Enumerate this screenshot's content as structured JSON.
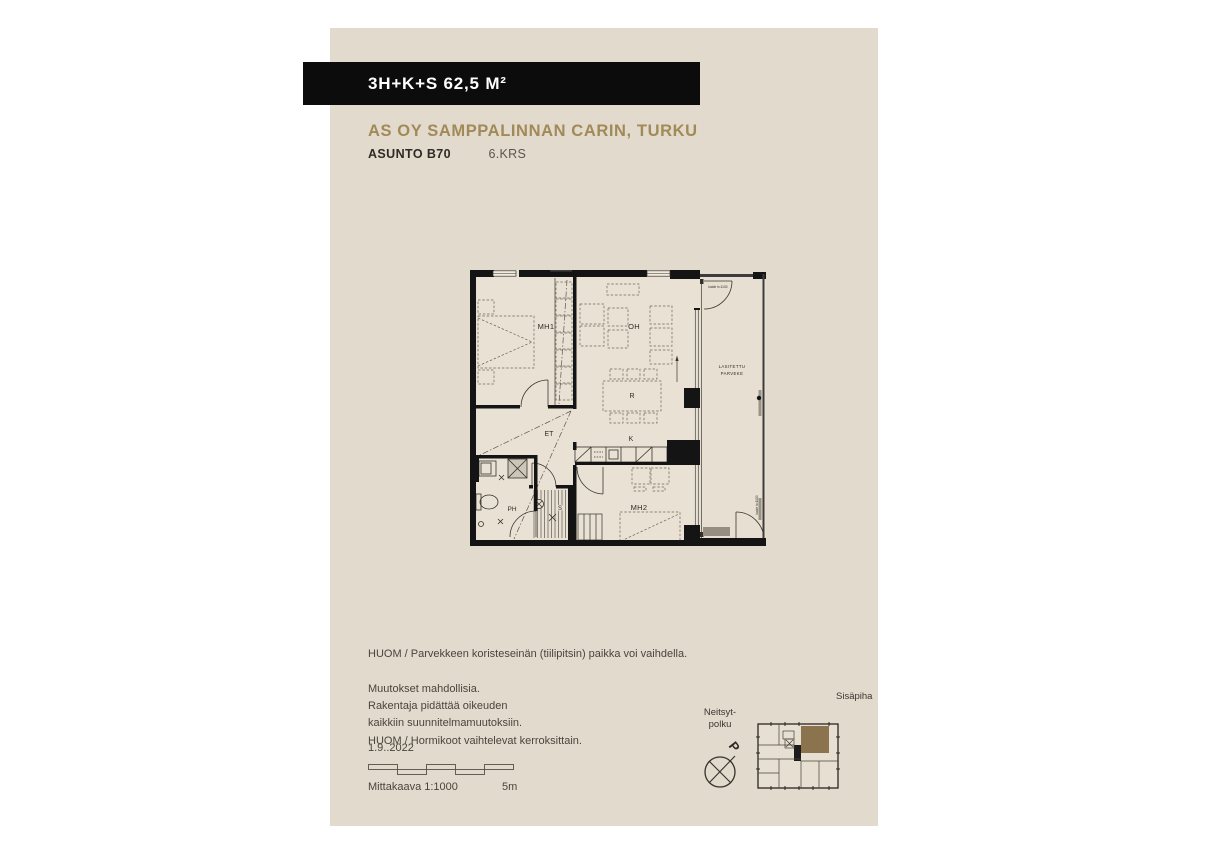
{
  "header": {
    "unit_type": "3H+K+S 62,5 M²",
    "project": "AS OY SAMPPALINNAN CARIN, TURKU",
    "apartment": "ASUNTO B70",
    "floor": "6.KRS"
  },
  "plan": {
    "rooms": {
      "mh1": "MH1",
      "oh": "OH",
      "r": "R",
      "k": "K",
      "et": "ET",
      "ph": "PH",
      "s": "S",
      "mh2": "MH2"
    },
    "balcony_line1": "LASITETTU",
    "balcony_line2": "PARVEKE",
    "railing_note": "kaide h=1100"
  },
  "notes": {
    "balcony_note": "HUOM / Parvekkeen koristeseinän (tiilipitsin) paikka voi vaihdella.",
    "disclaimer_lines": [
      "Muutokset mahdollisia.",
      "Rakentaja pidättää oikeuden",
      "kaikkiin suunnitelmamuutoksiin.",
      "HUOM / Hormikoot vaihtelevat kerroksittain."
    ],
    "date": "1.9..2022",
    "scale_label": "Mittakaava 1:1000",
    "scale_length": "5m"
  },
  "site": {
    "courtyard_label": "Sisäpiha",
    "street_label_line1": "Neitsyt-",
    "street_label_line2": "polku",
    "compass_letter": "P"
  },
  "colors": {
    "panel_bg": "#e2dacd",
    "banner_bg": "#0c0c0c",
    "accent_gold": "#a18a57",
    "unit_highlight_brown": "#8b734d",
    "plan_wall": "#141414"
  }
}
